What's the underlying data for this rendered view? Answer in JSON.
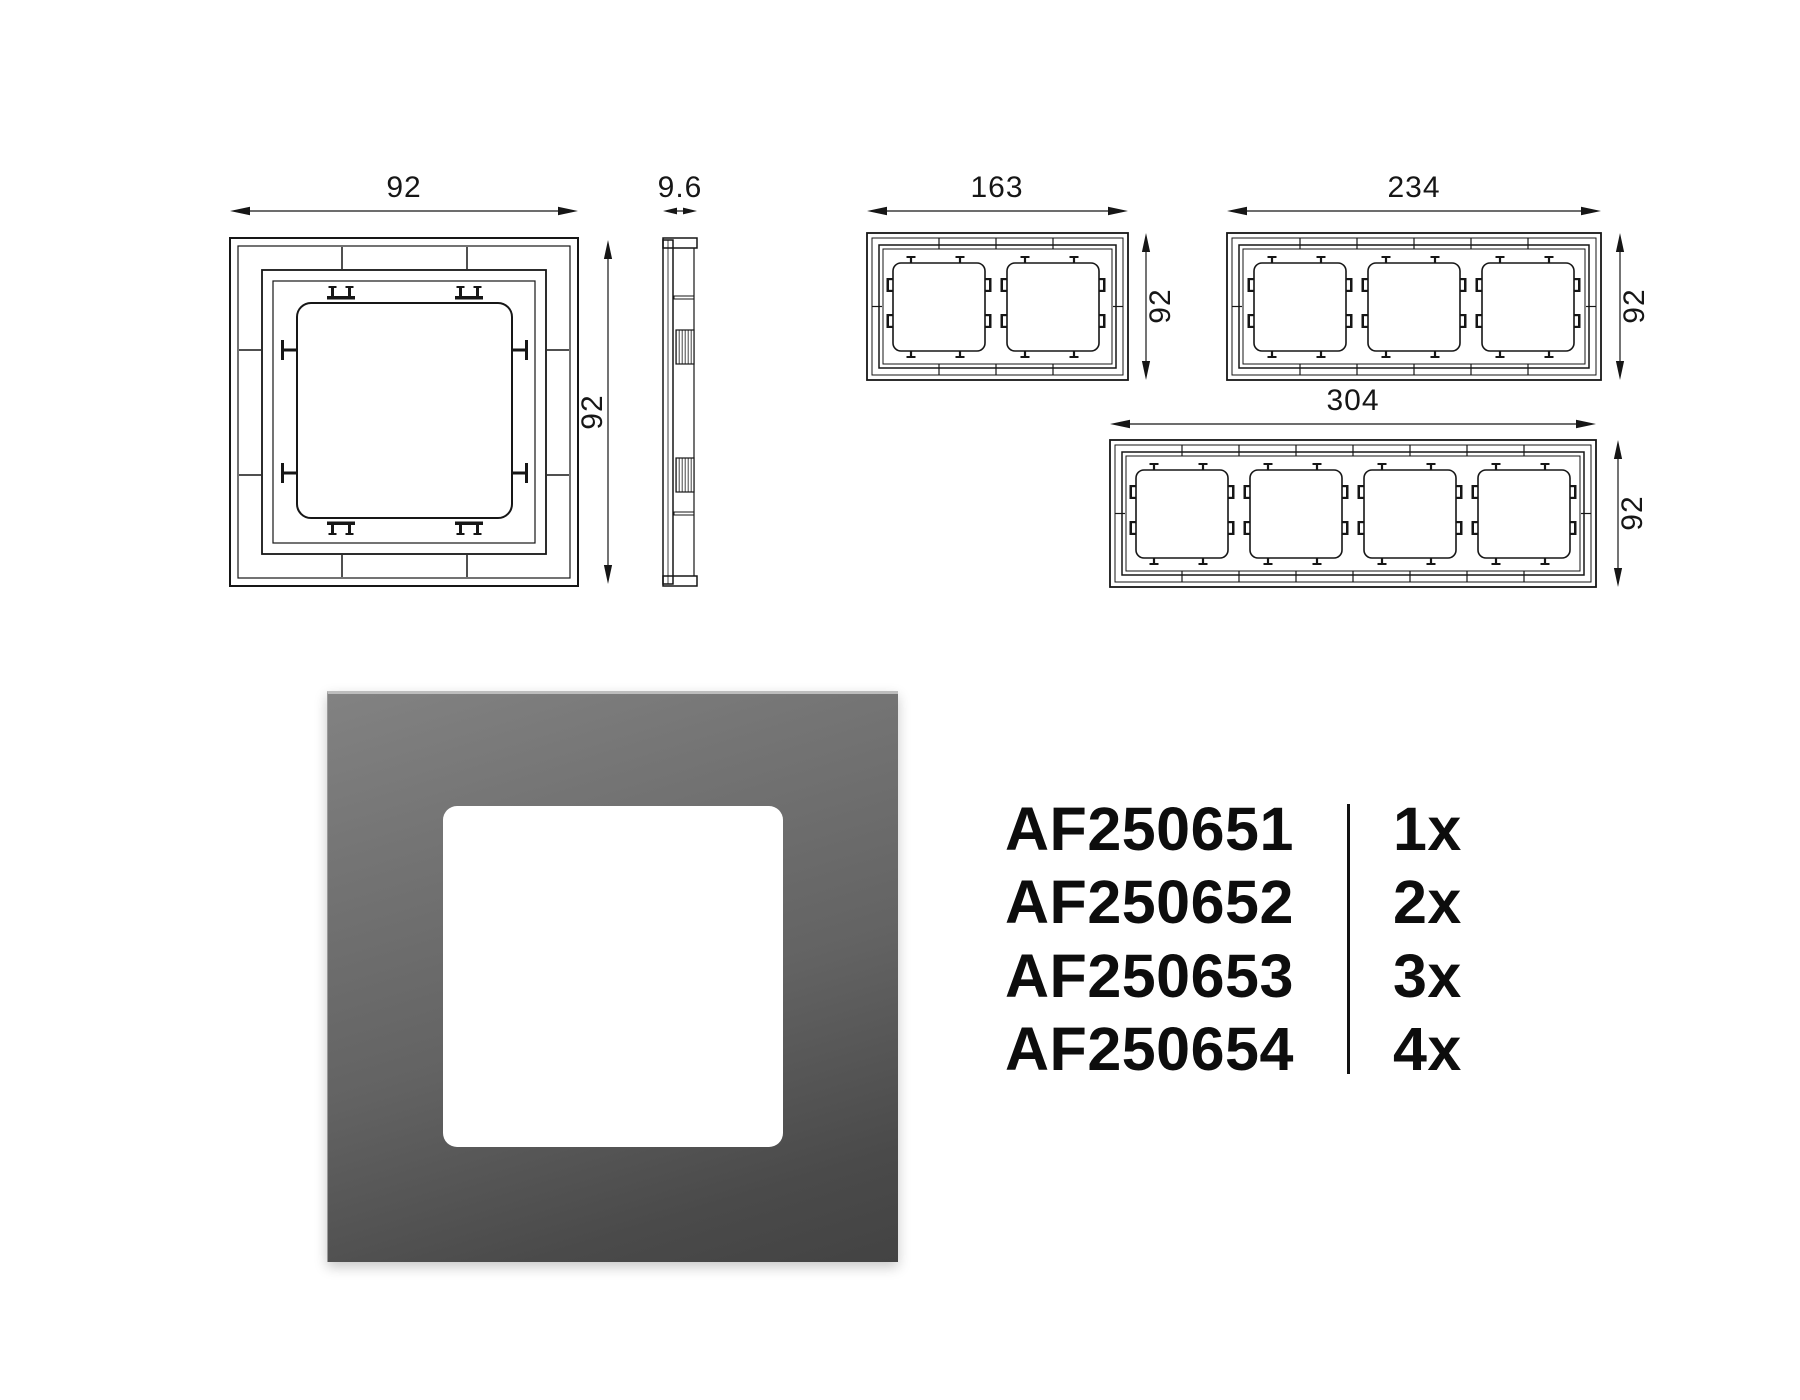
{
  "dimensions": {
    "single_front": {
      "width": "92",
      "height": "92"
    },
    "side_view": {
      "depth": "9.6"
    },
    "gang_2": {
      "width": "163",
      "height": "92"
    },
    "gang_3": {
      "width": "234",
      "height": "92"
    },
    "gang_4": {
      "width": "304",
      "height": "92"
    }
  },
  "product_table": {
    "rows": [
      {
        "code": "AF250651",
        "qty": "1x"
      },
      {
        "code": "AF250652",
        "qty": "2x"
      },
      {
        "code": "AF250653",
        "qty": "3x"
      },
      {
        "code": "AF250654",
        "qty": "4x"
      }
    ]
  },
  "product_photo": {
    "frame_color_top": "#828282",
    "frame_color_bottom": "#434343",
    "highlight_color": "#bdbdbd",
    "window_color": "#ffffff"
  },
  "line_color": "#161616"
}
